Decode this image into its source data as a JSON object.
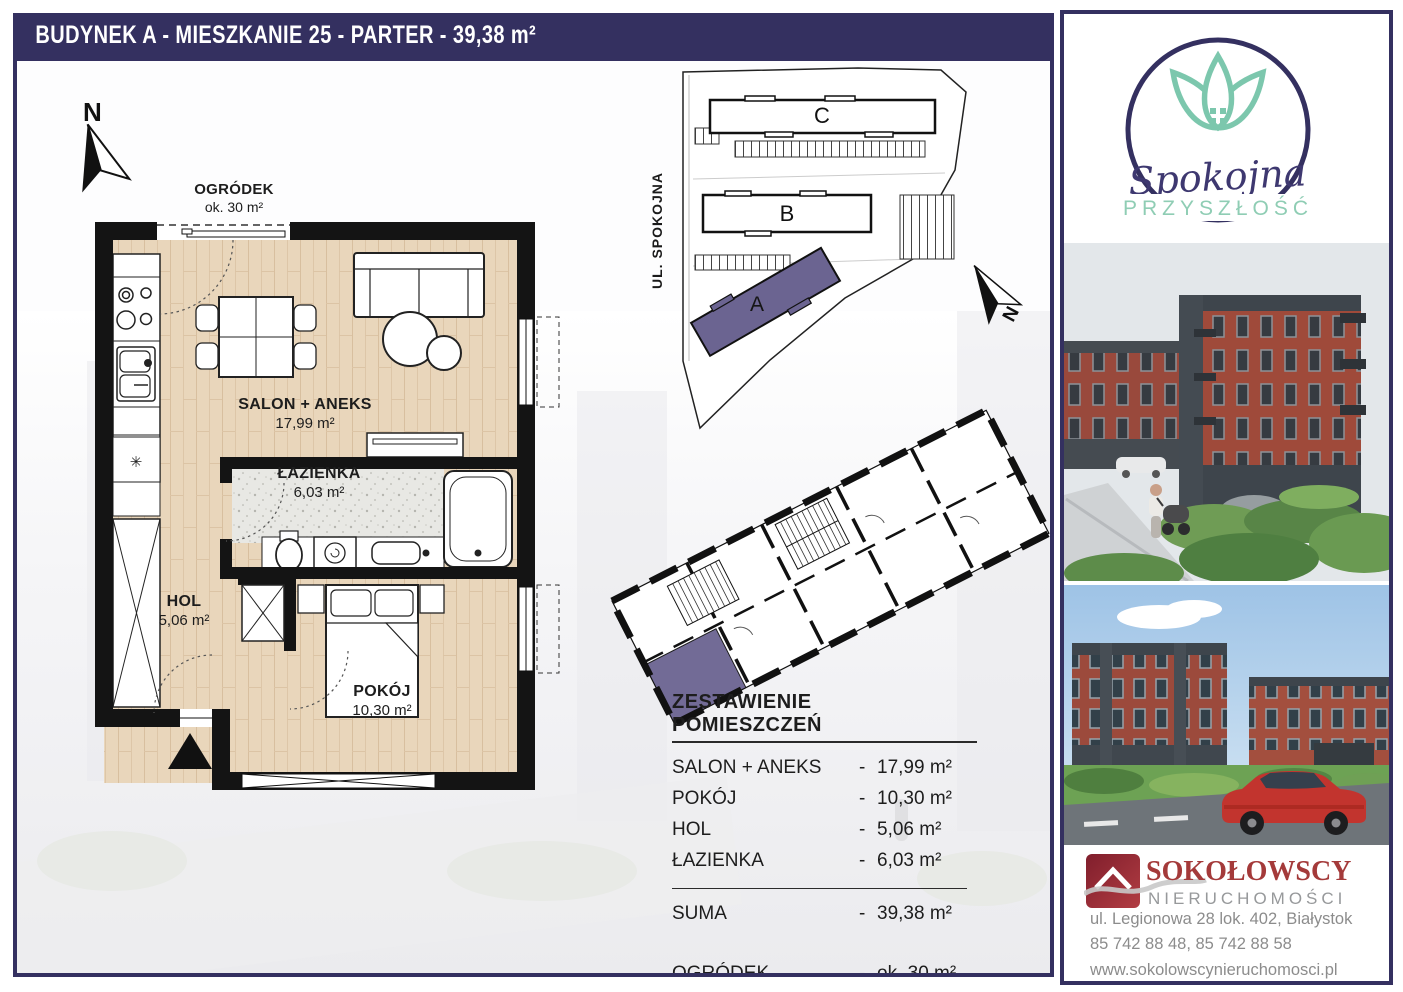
{
  "banner": {
    "title": "BUDYNEK A - MIESZKANIE 25 - PARTER - 39,38 m²"
  },
  "floor_plan": {
    "garden_label": "OGRÓDEK",
    "garden_area": "ok. 30 m²",
    "north_label": "N",
    "fridge_symbol": "✳",
    "rooms": [
      {
        "name": "SALON + ANEKS",
        "area": "17,99 m²"
      },
      {
        "name": "ŁAZIENKA",
        "area": "6,03 m²"
      },
      {
        "name": "HOL",
        "area": "5,06 m²"
      },
      {
        "name": "POKÓJ",
        "area": "10,30 m²"
      }
    ]
  },
  "site_plan": {
    "street": "UL. SPOKOJNA",
    "north_label": "N",
    "buildings": [
      "C",
      "B",
      "A"
    ],
    "highlight_color": "#6b6491"
  },
  "summary_table": {
    "title": "ZESTAWIENIE POMIESZCZEŃ",
    "dash": "-",
    "rows": [
      {
        "label": "SALON + ANEKS",
        "value": "17,99 m²"
      },
      {
        "label": "POKÓJ",
        "value": "10,30 m²"
      },
      {
        "label": "HOL",
        "value": "5,06 m²"
      },
      {
        "label": "ŁAZIENKA",
        "value": "6,03 m²"
      }
    ],
    "total": {
      "label": "SUMA",
      "value": "39,38 m²"
    },
    "garden": {
      "label": "OGRÓDEK",
      "value": "ok. 30 m²"
    }
  },
  "brand": {
    "name_script": "Spokojna",
    "name_caps": "PRZYSZŁOŚĆ"
  },
  "agency": {
    "name": "SOKOŁOWSCY",
    "subtitle": "NIERUCHOMOŚCI",
    "address": "ul. Legionowa 28 lok. 402, Białystok",
    "phones": "85 742 88 48,  85 742 88 58",
    "website": "www.sokolowscynieruchomosci.pl"
  },
  "colors": {
    "navy": "#343060",
    "teal": "#7cc7ad",
    "teal_light": "#8fcdb4",
    "purple": "#6b6491",
    "brand_red": "#a43a3a",
    "wood": "#e9d6bb"
  }
}
